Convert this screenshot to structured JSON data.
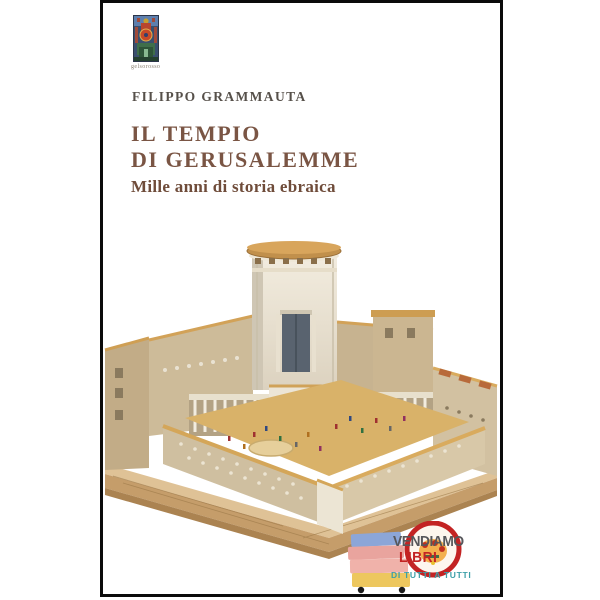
{
  "cover": {
    "author": "FILIPPO GRAMMAUTA",
    "title": "IL TEMPIO\nDI GERUSALEMME",
    "subtitle": "Mille anni di storia ebraica",
    "publisher_logo_caption": "gelsorosso",
    "colors": {
      "title": "#7a5544",
      "subtitle": "#6f4c3a",
      "author": "#56504a",
      "cover_border": "#0b0b0b",
      "cover_background": "#ffffff"
    }
  },
  "illustration": {
    "name": "temple-of-jerusalem-scale-model",
    "palette": {
      "stone_cream": "#efe9dc",
      "stone_tan": "#cdbb99",
      "roof_gold": "#d2a258",
      "courtyard_floor": "#d9b269",
      "doorway_slate": "#59636f",
      "wood_base": "#c59d6a"
    }
  },
  "sticker": {
    "word1": "VENDIAMO",
    "word2": "LIBRI",
    "word3": "DI TUTTI A TUTTI",
    "colors": {
      "word1": "#57575b",
      "word2": "#c32323",
      "word3": "#3d9fa8",
      "ring": "#c32323",
      "book_blue": "#8ca6d8",
      "book_salmon": "#e9a49e",
      "book_pink": "#f0b2aa",
      "book_yellow": "#edc75e",
      "wheel": "#1a1a1a"
    }
  },
  "icons": {
    "publisher_logo": "gelsorosso-mosaic-logo",
    "sticker_badge": "vendiamo-libri-book-cart-badge"
  }
}
